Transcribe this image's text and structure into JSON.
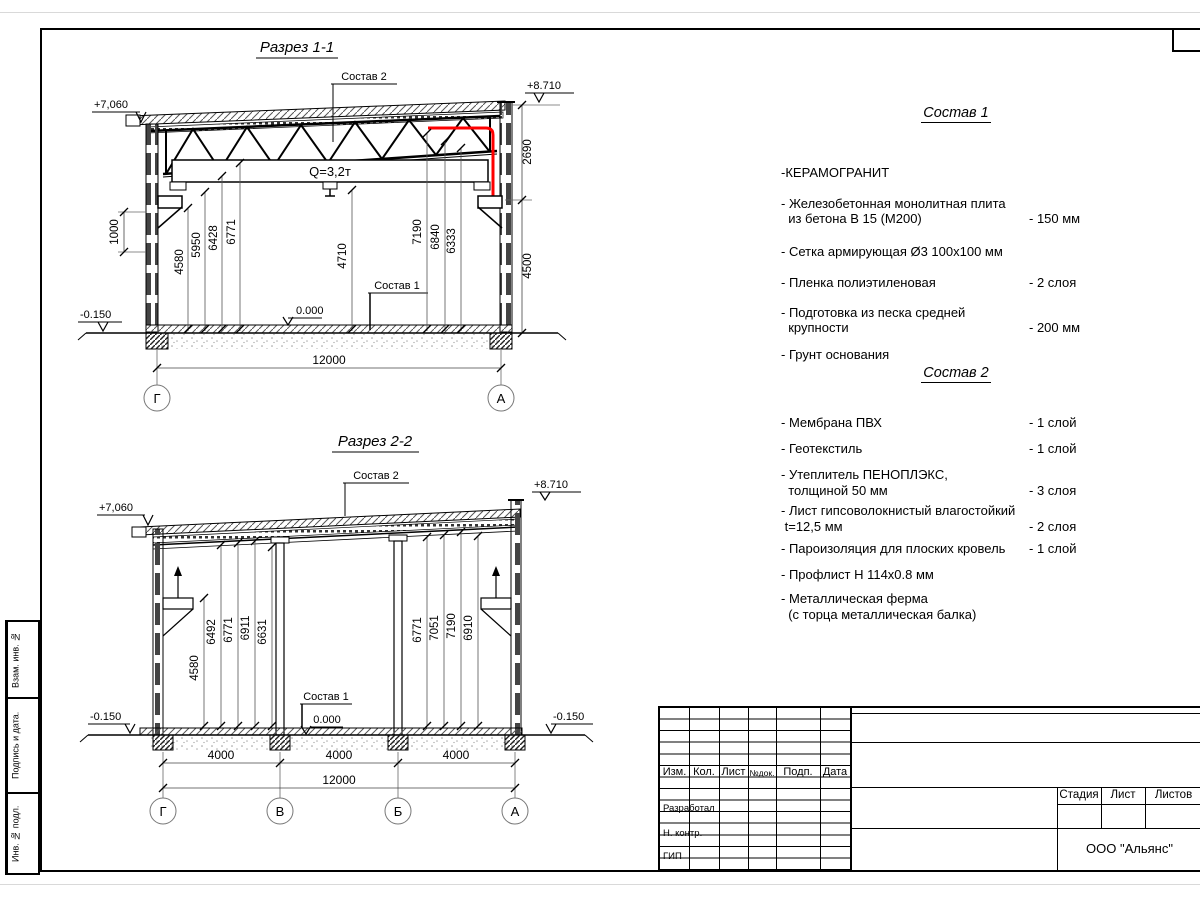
{
  "s1": {
    "title": "Разрез 1-1",
    "c2": "Состав 2",
    "c1": "Состав 1",
    "crane": "Q=3,2т",
    "e_eave": "+7,060",
    "e_top": "+8.710",
    "zero": "0.000",
    "minus": "-0.150",
    "d1000": "1000",
    "d2690": "2690",
    "d4500": "4500",
    "span": "12000",
    "h": [
      "4580",
      "5950",
      "6428",
      "6771"
    ],
    "mid": "4710",
    "hr": [
      "7190",
      "6840",
      "6333"
    ],
    "ax": [
      "Г",
      "А"
    ]
  },
  "s2": {
    "title": "Разрез 2-2",
    "c2": "Состав 2",
    "c1": "Состав 1",
    "e_eave": "+7,060",
    "e_top": "+8.710",
    "zero": "0.000",
    "minusL": "-0.150",
    "minusR": "-0.150",
    "h": [
      "4580",
      "6492",
      "6771",
      "6911",
      "6631"
    ],
    "hr": [
      "6771",
      "7051",
      "7190",
      "6910"
    ],
    "bays": [
      "4000",
      "4000",
      "4000"
    ],
    "span": "12000",
    "ax": [
      "Г",
      "В",
      "Б",
      "А"
    ]
  },
  "c1": {
    "title": "Состав 1",
    "items": [
      {
        "n": "-КЕРАМОГРАНИТ",
        "v": ""
      },
      {
        "n": "- Железобетонная  монолитная плита\n  из бетона В 15 (М200)",
        "v": "- 150 мм"
      },
      {
        "n": "- Сетка армирующая Ø3 100х100 мм",
        "v": ""
      },
      {
        "n": "- Пленка полиэтиленовая",
        "v": "-  2 слоя"
      },
      {
        "n": "- Подготовка из песка средней\n  крупности",
        "v": "- 200 мм"
      },
      {
        "n": "- Грунт основания",
        "v": ""
      }
    ]
  },
  "c2": {
    "title": "Состав 2",
    "items": [
      {
        "n": "- Мембрана ПВХ",
        "v": "- 1 слой"
      },
      {
        "n": "- Геотекстиль",
        "v": "- 1 слой"
      },
      {
        "n": "- Утеплитель ПЕНОПЛЭКС,\n  толщиной 50 мм",
        "v": "- 3 слоя"
      },
      {
        "n": "- Лист гипсоволокнистый влагостойкий\n t=12,5 мм",
        "v": "- 2 слоя"
      },
      {
        "n": "- Пароизоляция для плоских кровель",
        "v": "- 1 слой"
      },
      {
        "n": "- Профлист Н 114х0.8 мм",
        "v": ""
      },
      {
        "n": "- Металлическая ферма\n  (с торца металлическая балка)",
        "v": ""
      }
    ]
  },
  "tb": {
    "cols": [
      "Изм.",
      "Кол.",
      "Лист",
      "№док.",
      "Подп.",
      "Дата"
    ],
    "roles": {
      "r1": "Разработал",
      "r2": "Н. контр.",
      "r3": "ГИП"
    },
    "stage": [
      "Стадия",
      "Лист",
      "Листов"
    ],
    "company": "ООО \"Альянс\""
  },
  "stamp": [
    "Взам. инв. №",
    "Подпись  и  дата.",
    "Инв. № подл."
  ],
  "colors": {
    "highlight": "#ff0000",
    "line": "#000000"
  }
}
